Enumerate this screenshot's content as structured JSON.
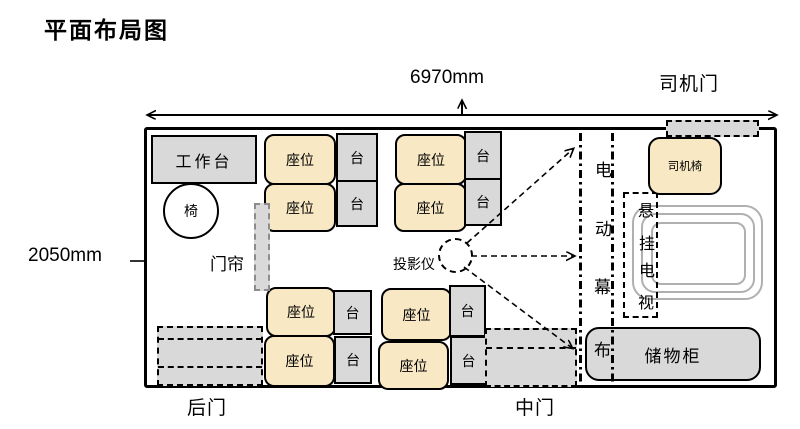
{
  "title": "平面布局图",
  "dimensions": {
    "width_label": "6970mm",
    "height_label": "2050mm"
  },
  "doors": {
    "driver": "司机门",
    "rear": "后门",
    "middle": "中门"
  },
  "furniture": {
    "workbench": "工作台",
    "chair": "椅",
    "curtain": "门帘",
    "seat": "座位",
    "side_table": "台",
    "projector": "投影仪",
    "driver_chair": "司机椅",
    "storage_cabinet": "储物柜",
    "screen_chars": [
      "电",
      "动",
      "幕",
      "布"
    ],
    "tv_chars": [
      "悬",
      "挂",
      "电",
      "视"
    ]
  },
  "colors": {
    "seat_fill": "#f8e9c4",
    "panel_gray": "#d9d9d9",
    "outline": "#000000",
    "tv_ring_gray": "#b0b0b0"
  }
}
